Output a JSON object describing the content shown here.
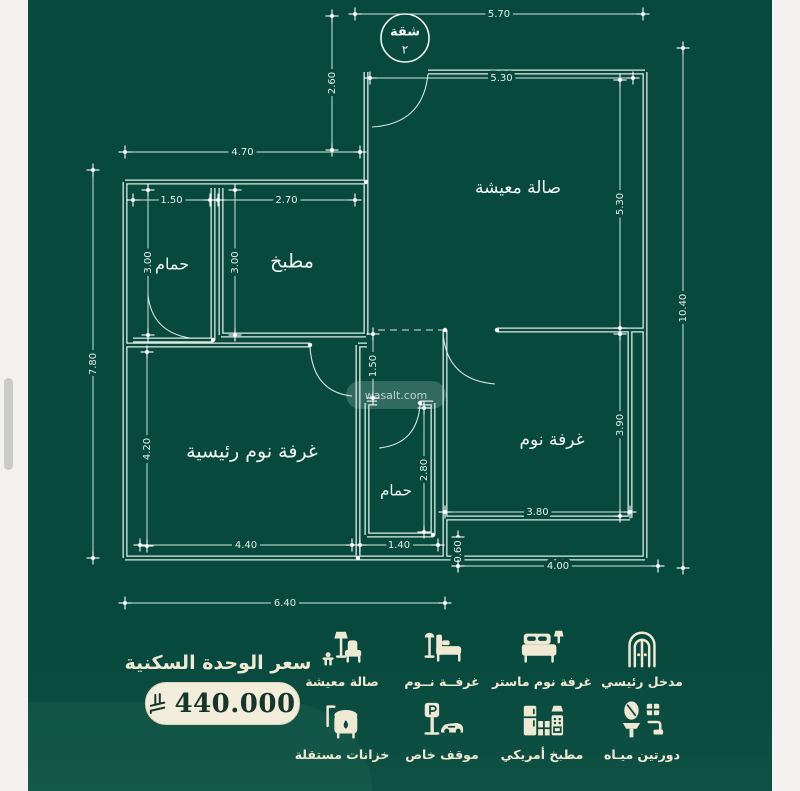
{
  "colors": {
    "background": "#07493d",
    "plan_line": "#dcece4",
    "cream": "#efe9d4",
    "pill_bg": "#f2eddb",
    "price_text": "#16352b",
    "scrollbar": "#cbcbc9"
  },
  "plan": {
    "badge": {
      "top": "شقة",
      "bottom": "٢"
    },
    "watermark": "wasalt.com",
    "rooms": [
      {
        "label": "صالة معيشة",
        "x": 518,
        "y": 188,
        "size": 17
      },
      {
        "label": "مطبخ",
        "x": 292,
        "y": 262,
        "size": 19
      },
      {
        "label": "حمام",
        "x": 172,
        "y": 265,
        "size": 16
      },
      {
        "label": "غرفة نوم رئيسية",
        "x": 252,
        "y": 452,
        "size": 19
      },
      {
        "label": "غرفة نوم",
        "x": 552,
        "y": 440,
        "size": 17
      },
      {
        "label": "حمام",
        "x": 396,
        "y": 491,
        "size": 15
      }
    ],
    "dimensions": [
      {
        "label": "5.70",
        "x1": 355,
        "y1": 14,
        "x2": 643,
        "y2": 14
      },
      {
        "label": "5.30",
        "x1": 370,
        "y1": 78,
        "x2": 633,
        "y2": 78
      },
      {
        "label": "2.60",
        "x1": 332,
        "y1": 16,
        "x2": 332,
        "y2": 150
      },
      {
        "label": "4.70",
        "x1": 125,
        "y1": 152,
        "x2": 360,
        "y2": 152
      },
      {
        "label": "1.50",
        "x1": 133,
        "y1": 200,
        "x2": 210,
        "y2": 200
      },
      {
        "label": "2.70",
        "x1": 218,
        "y1": 200,
        "x2": 355,
        "y2": 200
      },
      {
        "label": "3.00",
        "x1": 148,
        "y1": 190,
        "x2": 148,
        "y2": 335
      },
      {
        "label": "3.00",
        "x1": 235,
        "y1": 190,
        "x2": 235,
        "y2": 335
      },
      {
        "label": "7.80",
        "x1": 93,
        "y1": 170,
        "x2": 93,
        "y2": 558
      },
      {
        "label": "5.30",
        "x1": 620,
        "y1": 80,
        "x2": 620,
        "y2": 328
      },
      {
        "label": "3.90",
        "x1": 620,
        "y1": 334,
        "x2": 620,
        "y2": 516
      },
      {
        "label": "10.40",
        "x1": 683,
        "y1": 48,
        "x2": 683,
        "y2": 568
      },
      {
        "label": "1.50",
        "x1": 373,
        "y1": 334,
        "x2": 373,
        "y2": 398
      },
      {
        "label": "4.20",
        "x1": 147,
        "y1": 352,
        "x2": 147,
        "y2": 546
      },
      {
        "label": "4.40",
        "x1": 140,
        "y1": 545,
        "x2": 352,
        "y2": 545
      },
      {
        "label": "1.40",
        "x1": 360,
        "y1": 545,
        "x2": 438,
        "y2": 545
      },
      {
        "label": "2.80",
        "x1": 424,
        "y1": 408,
        "x2": 424,
        "y2": 532
      },
      {
        "label": "3.80",
        "x1": 445,
        "y1": 512,
        "x2": 630,
        "y2": 512
      },
      {
        "label": "0.60",
        "x1": 458,
        "y1": 537,
        "x2": 458,
        "y2": 566
      },
      {
        "label": "4.00",
        "x1": 458,
        "y1": 566,
        "x2": 658,
        "y2": 566
      },
      {
        "label": "6.40",
        "x1": 125,
        "y1": 603,
        "x2": 445,
        "y2": 603
      }
    ]
  },
  "price": {
    "title": "سعر الوحدة السكنية",
    "amount": "440.000",
    "currency": "ريال سعودي"
  },
  "features": {
    "rows": [
      [
        {
          "icon": "entrance",
          "label": "مدخل رئيسي"
        },
        {
          "icon": "masterbed",
          "label": "غرفة نوم ماستر"
        },
        {
          "icon": "bed",
          "label": "غرفــة نــوم"
        },
        {
          "icon": "living",
          "label": "صالة معيشة"
        }
      ],
      [
        {
          "icon": "wc",
          "label": "دورتين ميـاه"
        },
        {
          "icon": "kitchen",
          "label": "مطبخ أمريكي"
        },
        {
          "icon": "parking",
          "label": "موقف خاص"
        },
        {
          "icon": "tanks",
          "label": "خزانات مستقلة"
        }
      ]
    ]
  }
}
